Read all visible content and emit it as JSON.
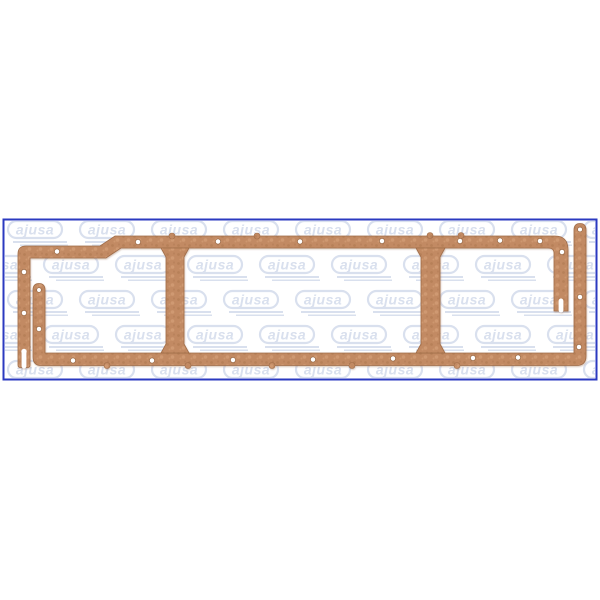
{
  "product_image": {
    "watermark": {
      "text": "ajusa"
    },
    "subject": "copper cork oil pan gasket, two-piece three-bay frame",
    "bolt_hole_count": 23
  },
  "colors": {
    "page-bg": "#ffffff",
    "border-blue": "#2b3ac0",
    "watermark-blue": "#d9e0ee",
    "copper-base": "#c28a63",
    "copper-dark": "#a9734e",
    "copper-light": "#d7a47c",
    "copper-edge": "#a06d49",
    "hole-rim": "#996945"
  }
}
